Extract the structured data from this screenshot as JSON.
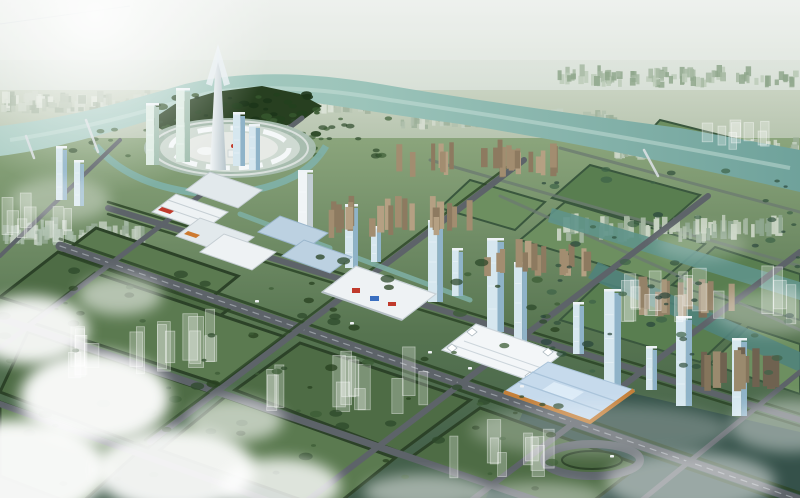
{
  "meta": {
    "type": "architectural-aerial-rendering",
    "canvas": {
      "w": 800,
      "h": 498
    },
    "alt_text": "Bird's-eye architectural rendering of a planned city district: a river loops around a central circular plaza with a white spire skyscraper and glass towers, a diagonal boulevard lined with white exhibition halls, a blue-roofed convention center with orange trim, tan residential slab rows, a grid of tree-lined green blocks with translucent future-phase buildings, and white clouds drifting over the lower left corner."
  },
  "palette": {
    "sky_top": "#eaeeea",
    "sky_horizon": "#ccd7ca",
    "far_band_top": "#c7d1bf",
    "far_band_bottom": "#adbda4",
    "ground_top": "#8ba57c",
    "ground_mid": "#567450",
    "ground_bottom": "#3e5a49",
    "river_left": "#aecfc6",
    "river_mid": "#9cc4ba",
    "river_right": "#6fa29b",
    "canal": "#5f948a",
    "canal_dark": "#4f837c",
    "median_water": "#7fb0a6",
    "parcel_a": "#4e6c45",
    "parcel_b": "#5b7a50",
    "hedge": "#2c4228",
    "field_a": "#6d8f60",
    "field_b": "#597e50",
    "field_line": "#3a573e",
    "road": "#5d6369",
    "road_line": "#969ca2",
    "road_far": "#6c7a72",
    "peninsula_trees": "#273f20",
    "plaza_ring": "#aabfb2",
    "plaza_deck": "#cfdad2",
    "plaza_inner": "#e7eae6",
    "canopy": "#f7fafb",
    "hall_white": "#eef2f4",
    "hall_shade": "#e2e9ec",
    "hall_edge": "#c5ced3",
    "hall_line": "#c9d2d7",
    "hall_blue": "#bcd1e1",
    "hall_blue_line": "#9ab6cc",
    "accent_red": "#c03a2c",
    "accent_orange": "#cd7a30",
    "expo_roof": "#c6daec",
    "expo_trim": "#c4803a",
    "expo_panel": "#a9c3da",
    "expo_sky": "#dcebf7",
    "tower_glass_light": "#d6e7ef",
    "tower_glass_dark": "#8fb3c8",
    "tower_green_light": "#dcebe2",
    "tower_green_dark": "#a3c0b1",
    "tower_white_light": "#f0f4f6",
    "tower_white_dark": "#c3ced4",
    "spire_light": "#f2f6f7",
    "spire_dark": "#b9c6cc",
    "cloud": "#ffffff",
    "ghost_fill": "rgba(255,255,255,0.26)",
    "ghost_edge": "rgba(255,255,255,0.45)",
    "bridge": "#d9dfe2",
    "car_white": "#eef1f3",
    "dark_corner": "#33504a"
  },
  "generators": {
    "seed": 1234,
    "clusters": [
      {
        "target": "gen-distant-left",
        "x": 0,
        "y": 60,
        "w": 392,
        "h": 54,
        "count": 200,
        "wMin": 3,
        "wMax": 9,
        "hMin": 4,
        "hMax": 13,
        "colors": [
          "#ccd6c8",
          "#b7c4b2",
          "#a2b39e",
          "#dde4d8"
        ],
        "opacity": 0.85
      },
      {
        "target": "gen-distant-right-a",
        "x": 400,
        "y": 88,
        "w": 210,
        "h": 42,
        "count": 90,
        "wMin": 3,
        "wMax": 8,
        "hMin": 4,
        "hMax": 11,
        "colors": [
          "#c6d2c4",
          "#b0c0ae",
          "#9cb09a",
          "#d4dccf"
        ],
        "opacity": 0.8
      },
      {
        "target": "gen-distant-right-b",
        "x": 612,
        "y": 96,
        "w": 183,
        "h": 64,
        "count": 110,
        "wMin": 3,
        "wMax": 8,
        "hMin": 4,
        "hMax": 12,
        "colors": [
          "#c6d2c4",
          "#b0c0ae",
          "#9cb09a",
          "#d4dccf"
        ],
        "opacity": 0.8
      },
      {
        "target": "gen-right-green",
        "x": 556,
        "y": 32,
        "w": 238,
        "h": 56,
        "count": 90,
        "wMin": 3,
        "wMax": 6,
        "hMin": 5,
        "hMax": 12,
        "colors": [
          "#bccbb8",
          "#a6b8a2",
          "#8fa78c"
        ],
        "opacity": 0.85
      },
      {
        "target": "gen-left-low",
        "x": 0,
        "y": 148,
        "w": 142,
        "h": 98,
        "count": 60,
        "wMin": 3,
        "wMax": 8,
        "hMin": 6,
        "hMax": 18,
        "colors": [
          "#c4d0c2",
          "#adbfae",
          "#97ab97"
        ],
        "opacity": 0.8
      },
      {
        "target": "gen-river-res",
        "x": 396,
        "y": 128,
        "w": 168,
        "h": 50,
        "count": 26,
        "wMin": 4,
        "wMax": 7,
        "hMin": 16,
        "hMax": 30,
        "colors": [
          "#b5a083",
          "#a28d70",
          "#8d7a60"
        ],
        "opacity": 1
      },
      {
        "target": "gen-right-res",
        "x": 545,
        "y": 163,
        "w": 235,
        "h": 80,
        "count": 70,
        "wMin": 3,
        "wMax": 7,
        "hMin": 8,
        "hMax": 20,
        "colors": [
          "#b9c7b4",
          "#a3b5a0",
          "#8ea68f",
          "#c9d4c4"
        ],
        "opacity": 0.95
      },
      {
        "target": "gen-axis-res1",
        "x": 328,
        "y": 188,
        "w": 142,
        "h": 50,
        "count": 22,
        "wMin": 5,
        "wMax": 8,
        "hMin": 18,
        "hMax": 32,
        "colors": [
          "#b5a083",
          "#a28d70",
          "#8d7a60"
        ],
        "opacity": 1
      },
      {
        "target": "gen-axis-res2",
        "x": 478,
        "y": 230,
        "w": 112,
        "h": 48,
        "count": 15,
        "wMin": 5,
        "wMax": 8,
        "hMin": 18,
        "hMax": 30,
        "colors": [
          "#b5a083",
          "#a28d70",
          "#8d7a60"
        ],
        "opacity": 1
      },
      {
        "target": "gen-axis-res3",
        "x": 615,
        "y": 266,
        "w": 120,
        "h": 52,
        "count": 15,
        "wMin": 5,
        "wMax": 9,
        "hMin": 20,
        "hMax": 34,
        "colors": [
          "#a8977b",
          "#948268",
          "#7d6d57"
        ],
        "opacity": 1
      },
      {
        "target": "gen-axis-res4",
        "x": 698,
        "y": 328,
        "w": 96,
        "h": 64,
        "count": 13,
        "wMin": 6,
        "wMax": 10,
        "hMin": 24,
        "hMax": 42,
        "colors": [
          "#9a8a6e",
          "#85755c",
          "#6f6250"
        ],
        "opacity": 1
      }
    ],
    "ghosts": [
      {
        "target": "gen-ghost-1",
        "x": 40,
        "y": 258,
        "w": 210,
        "h": 122,
        "count": 16,
        "wMin": 8,
        "wMax": 16,
        "hMin": 22,
        "hMax": 60
      },
      {
        "target": "gen-ghost-2",
        "x": 255,
        "y": 298,
        "w": 165,
        "h": 117,
        "count": 13,
        "wMin": 8,
        "wMax": 15,
        "hMin": 20,
        "hMax": 55
      },
      {
        "target": "gen-ghost-3",
        "x": 430,
        "y": 393,
        "w": 150,
        "h": 87,
        "count": 9,
        "wMin": 8,
        "wMax": 14,
        "hMin": 18,
        "hMax": 45
      },
      {
        "target": "gen-ghost-4",
        "x": 615,
        "y": 173,
        "w": 175,
        "h": 152,
        "count": 15,
        "wMin": 8,
        "wMax": 14,
        "hMin": 20,
        "hMax": 50
      },
      {
        "target": "gen-ghost-5",
        "x": 0,
        "y": 168,
        "w": 72,
        "h": 74,
        "count": 7,
        "wMin": 7,
        "wMax": 12,
        "hMin": 18,
        "hMax": 40
      },
      {
        "target": "gen-ghost-6",
        "x": 690,
        "y": 93,
        "w": 105,
        "h": 60,
        "count": 8,
        "wMin": 6,
        "wMax": 11,
        "hMin": 14,
        "hMax": 34
      }
    ],
    "trees": [
      {
        "target": "gen-trees-fg",
        "x": 0,
        "y": 253,
        "w": 560,
        "h": 237,
        "count": 95,
        "rMin": 2,
        "rMax": 7,
        "colors": [
          "#2e4a2b",
          "#3c5c35",
          "#27401f"
        ],
        "opacity": 0.75
      },
      {
        "target": "gen-trees-right",
        "x": 540,
        "y": 168,
        "w": 260,
        "h": 205,
        "count": 60,
        "rMin": 2,
        "rMax": 6,
        "colors": [
          "#2f4f3c",
          "#3d6247",
          "#28453a"
        ],
        "opacity": 0.7
      },
      {
        "target": "gen-trees-peninsula",
        "x": 152,
        "y": 92,
        "w": 166,
        "h": 46,
        "count": 48,
        "rMin": 2,
        "rMax": 6,
        "colors": [
          "#24401e",
          "#35552c",
          "#1d3519"
        ],
        "opacity": 0.9
      },
      {
        "target": "gen-trees-northbank",
        "x": 60,
        "y": 118,
        "w": 340,
        "h": 40,
        "count": 40,
        "rMin": 2,
        "rMax": 5,
        "colors": [
          "#2e4a2b",
          "#3c5c35"
        ],
        "opacity": 0.7
      }
    ],
    "towers": [
      {
        "x": 146,
        "b": 165,
        "h": 60,
        "w": 13,
        "k": "green"
      },
      {
        "x": 176,
        "b": 162,
        "h": 72,
        "w": 14,
        "k": "green"
      },
      {
        "x": 233,
        "b": 166,
        "h": 52,
        "w": 12,
        "k": "blue"
      },
      {
        "x": 249,
        "b": 170,
        "h": 44,
        "w": 11,
        "k": "blue"
      },
      {
        "x": 56,
        "b": 200,
        "h": 52,
        "w": 11,
        "k": "blue"
      },
      {
        "x": 74,
        "b": 206,
        "h": 44,
        "w": 10,
        "k": "blue"
      },
      {
        "x": 298,
        "b": 252,
        "h": 80,
        "w": 15,
        "k": "white"
      },
      {
        "x": 345,
        "b": 268,
        "h": 62,
        "w": 13,
        "k": "blue"
      },
      {
        "x": 371,
        "b": 262,
        "h": 34,
        "w": 10,
        "k": "blue"
      },
      {
        "x": 428,
        "b": 302,
        "h": 80,
        "w": 15,
        "k": "blue"
      },
      {
        "x": 452,
        "b": 296,
        "h": 46,
        "w": 11,
        "k": "blue"
      },
      {
        "x": 487,
        "b": 332,
        "h": 92,
        "w": 17,
        "k": "blue"
      },
      {
        "x": 514,
        "b": 342,
        "h": 78,
        "w": 13,
        "k": "blue"
      },
      {
        "x": 573,
        "b": 354,
        "h": 50,
        "w": 11,
        "k": "blue"
      },
      {
        "x": 604,
        "b": 386,
        "h": 95,
        "w": 17,
        "k": "blue"
      },
      {
        "x": 646,
        "b": 390,
        "h": 42,
        "w": 11,
        "k": "blue"
      },
      {
        "x": 676,
        "b": 406,
        "h": 88,
        "w": 16,
        "k": "blue"
      },
      {
        "x": 732,
        "b": 416,
        "h": 76,
        "w": 15,
        "k": "blue"
      }
    ],
    "cars": [
      {
        "x": 428,
        "y": 351
      },
      {
        "x": 468,
        "y": 367
      },
      {
        "x": 520,
        "y": 385
      },
      {
        "x": 350,
        "y": 322
      },
      {
        "x": 610,
        "y": 455
      },
      {
        "x": 255,
        "y": 300
      }
    ]
  }
}
